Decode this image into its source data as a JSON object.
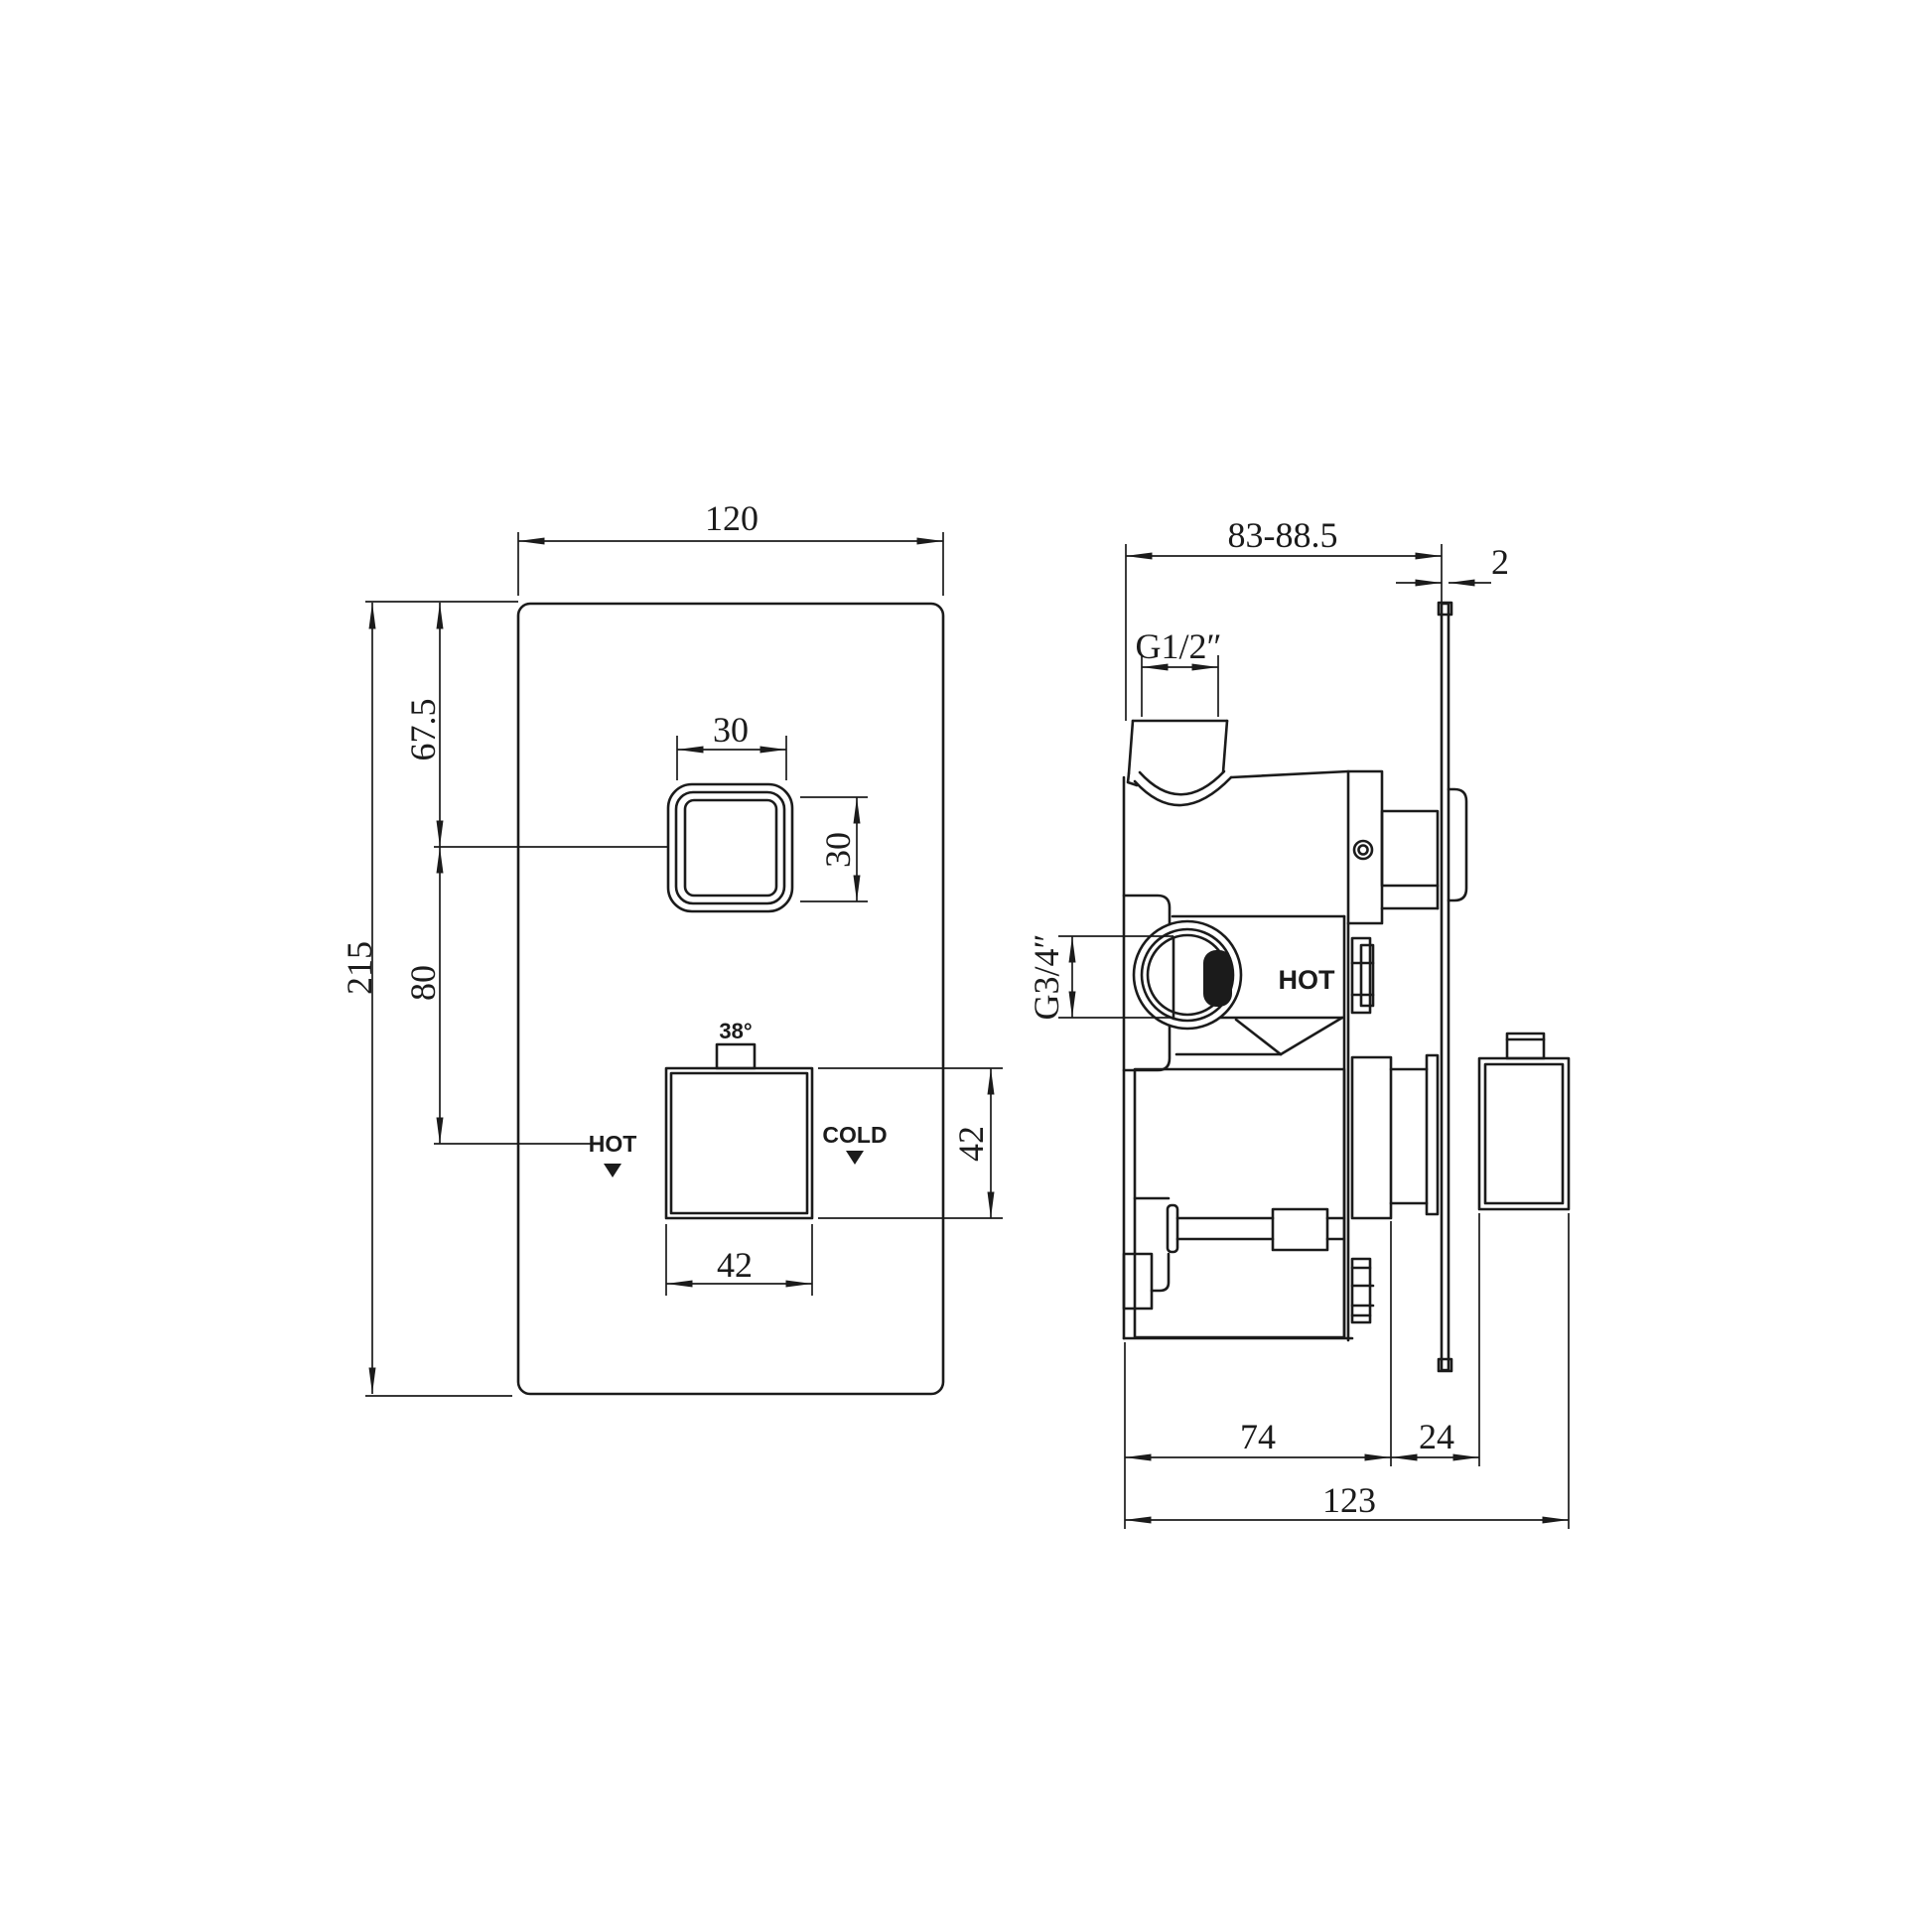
{
  "drawing": {
    "background": "#ffffff",
    "line_color": "#1b1b1b",
    "front_view": {
      "dim_plate_width": "120",
      "dim_plate_height": "215",
      "dim_button_offset_top": "67.5",
      "dim_button_spacing": "80",
      "dim_button_width": "30",
      "dim_button_height": "30",
      "temp_stop_label": "38°",
      "hot_label": "HOT",
      "cold_label": "COLD",
      "dim_handle_width": "42",
      "dim_handle_height": "42"
    },
    "side_view": {
      "dim_depth_range": "83-88.5",
      "dim_plate_thickness": "2",
      "inlet_thread_label": "G1/2″",
      "outlet_thread_label": "G3/4″",
      "hot_label": "HOT",
      "dim_body_depth": "74",
      "dim_knob_depth": "24",
      "dim_total_depth": "123"
    }
  }
}
